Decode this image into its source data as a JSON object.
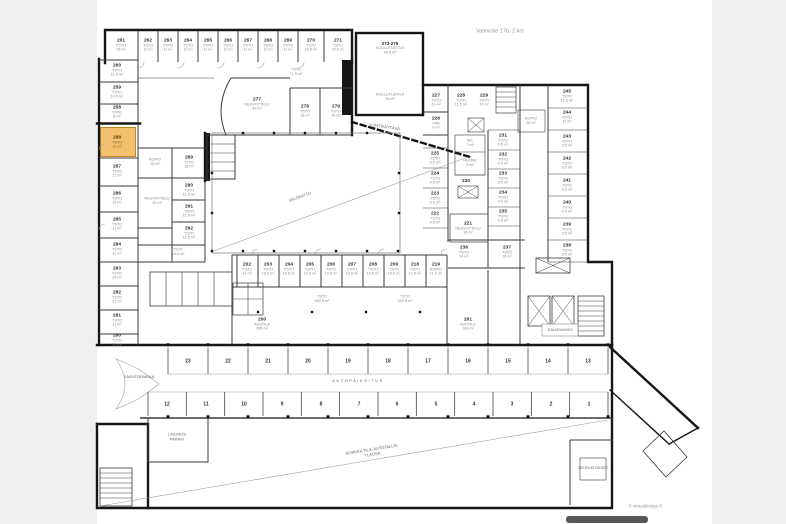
{
  "header": {
    "address": "Valimotie 17b, 2.krs"
  },
  "footer": {
    "copyright": "© virtualdesign.fi"
  },
  "colors": {
    "highlight_fill": "#f2c06f",
    "highlight_border": "#c2861f",
    "wall": "#161616",
    "paper": "#ffffff",
    "background": "#efefef"
  },
  "highlighted_room": {
    "number": "288",
    "type": "TSTO",
    "area": "11 m²"
  },
  "rooms": [
    {
      "n": "261",
      "t": "TSTO",
      "a": "23 m²",
      "x": 121,
      "y": 45
    },
    {
      "n": "262",
      "t": "TSTO",
      "a": "11 m²",
      "x": 148,
      "y": 45
    },
    {
      "n": "263",
      "t": "TSTO",
      "a": "11 m²",
      "x": 168,
      "y": 45
    },
    {
      "n": "264",
      "t": "TSTO",
      "a": "11 m²",
      "x": 188,
      "y": 45
    },
    {
      "n": "265",
      "t": "TSTO",
      "a": "11 m²",
      "x": 208,
      "y": 45
    },
    {
      "n": "266",
      "t": "TSTO",
      "a": "11 m²",
      "x": 228,
      "y": 45
    },
    {
      "n": "267",
      "t": "TSTO",
      "a": "11 m²",
      "x": 248,
      "y": 45
    },
    {
      "n": "268",
      "t": "TSTO",
      "a": "11 m²",
      "x": 268,
      "y": 45
    },
    {
      "n": "269",
      "t": "TSTO",
      "a": "11 m²",
      "x": 288,
      "y": 45
    },
    {
      "n": "270",
      "t": "TSTO",
      "a": "23.5 m²",
      "x": 311,
      "y": 45
    },
    {
      "n": "271",
      "t": "TSTO",
      "a": "22.5 m²",
      "x": 338,
      "y": 45
    },
    {
      "n": "260",
      "t": "TSTO",
      "a": "11.5 m²",
      "x": 117,
      "y": 70
    },
    {
      "n": "259",
      "t": "TSTO",
      "a": "14.5 m²",
      "x": 117,
      "y": 92
    },
    {
      "n": "258",
      "t": "TSTO",
      "a": "8 m²",
      "x": 117,
      "y": 112
    },
    {
      "n": "288",
      "t": "TSTO",
      "a": "11 m²",
      "x": 117,
      "y": 142,
      "hl": true
    },
    {
      "n": "287",
      "t": "TSTO",
      "a": "11 m²",
      "x": 117,
      "y": 171
    },
    {
      "n": "286",
      "t": "TSTO",
      "a": "11 m²",
      "x": 117,
      "y": 198
    },
    {
      "n": "285",
      "t": "TSTO",
      "a": "11 m²",
      "x": 117,
      "y": 224
    },
    {
      "n": "284",
      "t": "TSTO",
      "a": "11 m²",
      "x": 117,
      "y": 249
    },
    {
      "n": "283",
      "t": "TSTO",
      "a": "24 m²",
      "x": 117,
      "y": 273
    },
    {
      "n": "282",
      "t": "TSTO",
      "a": "21 m²",
      "x": 117,
      "y": 297
    },
    {
      "n": "281",
      "t": "TSTO",
      "a": "11 m²",
      "x": 117,
      "y": 320
    },
    {
      "n": "280",
      "t": "TSTO",
      "a": "15 m²",
      "x": 117,
      "y": 340
    },
    {
      "n": "289",
      "t": "TSTO",
      "a": "15 m²",
      "x": 189,
      "y": 162
    },
    {
      "n": "290",
      "t": "TSTO",
      "a": "11.5 m²",
      "x": 189,
      "y": 190
    },
    {
      "n": "291",
      "t": "TSTO",
      "a": "11.5 m²",
      "x": 189,
      "y": 211
    },
    {
      "n": "292",
      "t": "TSTO",
      "a": "11.5 m²",
      "x": 189,
      "y": 233
    },
    {
      "n": "277",
      "t": "NEUVOTTELU",
      "a": "40 m²",
      "x": 257,
      "y": 104
    },
    {
      "n": "278",
      "t": "TSTO",
      "a": "16 m²",
      "x": 305,
      "y": 111
    },
    {
      "n": "279",
      "t": "TSTO",
      "a": "16 m²",
      "x": 336,
      "y": 111
    },
    {
      "n": "202",
      "t": "TSTO",
      "a": "14 m²",
      "x": 247,
      "y": 269
    },
    {
      "n": "203",
      "t": "TSTO",
      "a": "10.5 m²",
      "x": 268,
      "y": 269
    },
    {
      "n": "204",
      "t": "TSTO",
      "a": "10.5 m²",
      "x": 289,
      "y": 269
    },
    {
      "n": "205",
      "t": "TSTO",
      "a": "10.5 m²",
      "x": 310,
      "y": 269
    },
    {
      "n": "206",
      "t": "TSTO",
      "a": "10.5 m²",
      "x": 331,
      "y": 269
    },
    {
      "n": "207",
      "t": "TSTO",
      "a": "10.5 m²",
      "x": 352,
      "y": 269
    },
    {
      "n": "208",
      "t": "TSTO",
      "a": "10.5 m²",
      "x": 373,
      "y": 269
    },
    {
      "n": "209",
      "t": "TSTO",
      "a": "10.5 m²",
      "x": 394,
      "y": 269
    },
    {
      "n": "218",
      "t": "TSTO",
      "a": "11.5 m²",
      "x": 415,
      "y": 269
    },
    {
      "n": "219",
      "t": "KOPIO",
      "a": "11.5 m²",
      "x": 436,
      "y": 269
    },
    {
      "n": "200",
      "t": "AVOTILA",
      "a": "396 m²",
      "x": 262,
      "y": 324
    },
    {
      "n": "201",
      "t": "AVOTILA",
      "a": "183 m²",
      "x": 468,
      "y": 324
    },
    {
      "n": "227",
      "t": "TSTO",
      "a": "21 m²",
      "x": 436,
      "y": 100
    },
    {
      "n": "228",
      "t": "TSTO",
      "a": "11.5 m²",
      "x": 461,
      "y": 100
    },
    {
      "n": "229",
      "t": "TSTO",
      "a": "17 m²",
      "x": 484,
      "y": 100
    },
    {
      "n": "226",
      "t": "VAR",
      "a": "9 m²",
      "x": 436,
      "y": 123
    },
    {
      "n": "225",
      "t": "TSTO",
      "a": "9.5 m²",
      "x": 435,
      "y": 158
    },
    {
      "n": "224",
      "t": "TSTO",
      "a": "9.5 m²",
      "x": 435,
      "y": 178
    },
    {
      "n": "223",
      "t": "TSTO",
      "a": "9.5 m²",
      "x": 435,
      "y": 198
    },
    {
      "n": "222",
      "t": "TSTO",
      "a": "9.5 m²",
      "x": 435,
      "y": 218
    },
    {
      "n": "221",
      "t": "NEUVOTTELU",
      "a": "16 m²",
      "x": 468,
      "y": 228
    },
    {
      "n": "230",
      "t": "",
      "a": "",
      "x": 466,
      "y": 181
    },
    {
      "n": "231",
      "t": "TSTO",
      "a": "9.5 m²",
      "x": 503,
      "y": 140
    },
    {
      "n": "232",
      "t": "TSTO",
      "a": "9.5 m²",
      "x": 503,
      "y": 159
    },
    {
      "n": "233",
      "t": "TSTO",
      "a": "9.5 m²",
      "x": 503,
      "y": 178
    },
    {
      "n": "234",
      "t": "TSTO",
      "a": "9.5 m²",
      "x": 503,
      "y": 197
    },
    {
      "n": "235",
      "t": "TSTO",
      "a": "9.5 m²",
      "x": 503,
      "y": 216
    },
    {
      "n": "236",
      "t": "TSTO",
      "a": "14 m²",
      "x": 464,
      "y": 252
    },
    {
      "n": "237",
      "t": "TSTO",
      "a": "16 m²",
      "x": 507,
      "y": 252
    },
    {
      "n": "245",
      "t": "TSTO",
      "a": "11.5 m²",
      "x": 567,
      "y": 96
    },
    {
      "n": "244",
      "t": "TSTO",
      "a": "11 m²",
      "x": 567,
      "y": 117
    },
    {
      "n": "243",
      "t": "TSTO",
      "a": "9.5 m²",
      "x": 567,
      "y": 141
    },
    {
      "n": "242",
      "t": "TSTO",
      "a": "9.5 m²",
      "x": 567,
      "y": 163
    },
    {
      "n": "241",
      "t": "TSTO",
      "a": "9.5 m²",
      "x": 567,
      "y": 185
    },
    {
      "n": "240",
      "t": "TSTO",
      "a": "9.5 m²",
      "x": 567,
      "y": 207
    },
    {
      "n": "239",
      "t": "TSTO",
      "a": "9.5 m²",
      "x": 567,
      "y": 229
    },
    {
      "n": "238",
      "t": "TSTO",
      "a": "9.5 m²",
      "x": 567,
      "y": 250
    }
  ],
  "area_labels": [
    {
      "lines": [
        "273-276",
        "KOULUTUSTILA",
        "43.5 m²"
      ],
      "x": 390,
      "y": 48,
      "b": true
    },
    {
      "lines": [
        "KOULUTUSTILA",
        "76 m²"
      ],
      "x": 390,
      "y": 97
    },
    {
      "lines": [
        "TSTO",
        "71.5 m²"
      ],
      "x": 296,
      "y": 72
    },
    {
      "lines": [
        "KOPIO",
        "20 m²"
      ],
      "x": 155,
      "y": 162
    },
    {
      "lines": [
        "NEUVOTTELU",
        "42 m²"
      ],
      "x": 157,
      "y": 201
    },
    {
      "lines": [
        "TSTO",
        "16.5 m²"
      ],
      "x": 178,
      "y": 252
    },
    {
      "lines": [
        "TSTO",
        "460.5 m²"
      ],
      "x": 322,
      "y": 299
    },
    {
      "lines": [
        "TSTO",
        "263.5 m²"
      ],
      "x": 405,
      "y": 299
    },
    {
      "lines": [
        "WC",
        "7 m²"
      ],
      "x": 470,
      "y": 143
    },
    {
      "lines": [
        "HUONE",
        "9 m²"
      ],
      "x": 470,
      "y": 163
    },
    {
      "lines": [
        "KOPIO",
        "25 m²"
      ],
      "x": 531,
      "y": 121
    }
  ],
  "annotations": [
    {
      "lines": [
        "VALOKATTO"
      ],
      "x": 300,
      "y": 197,
      "rot": -20
    },
    {
      "lines": [
        "LUHTIKÄYTÄVÄ"
      ],
      "x": 385,
      "y": 127,
      "rot": 9
    },
    {
      "lines": [
        "AUTOPAIKOITUS"
      ],
      "x": 358,
      "y": 381,
      "rot": 0,
      "spaced": true
    },
    {
      "lines": [
        "KÄÄNTÖPAIKKA"
      ],
      "x": 139,
      "y": 377,
      "rot": 0
    },
    {
      "lines": [
        "KORKEA TILA, AUTOTALLIN",
        "YLÄOSA"
      ],
      "x": 372,
      "y": 452,
      "rot": -9
    },
    {
      "lines": [
        "LASTAUS",
        "PARKKI"
      ],
      "x": 177,
      "y": 437,
      "rot": 0
    },
    {
      "lines": [
        "JÄTEKATOKSET"
      ],
      "x": 593,
      "y": 468,
      "rot": 0
    },
    {
      "lines": [
        "SALI/KAHVIO"
      ],
      "x": 560,
      "y": 330,
      "rot": 0
    }
  ],
  "parking": {
    "aisle_label": "AUTOPAIKOITUS",
    "row1": [
      "23",
      "22",
      "21",
      "20",
      "19",
      "18",
      "17",
      "16",
      "15",
      "14",
      "13"
    ],
    "row2": [
      "12",
      "11",
      "10",
      "9",
      "8",
      "7",
      "6",
      "5",
      "4",
      "3",
      "2",
      "1"
    ]
  }
}
